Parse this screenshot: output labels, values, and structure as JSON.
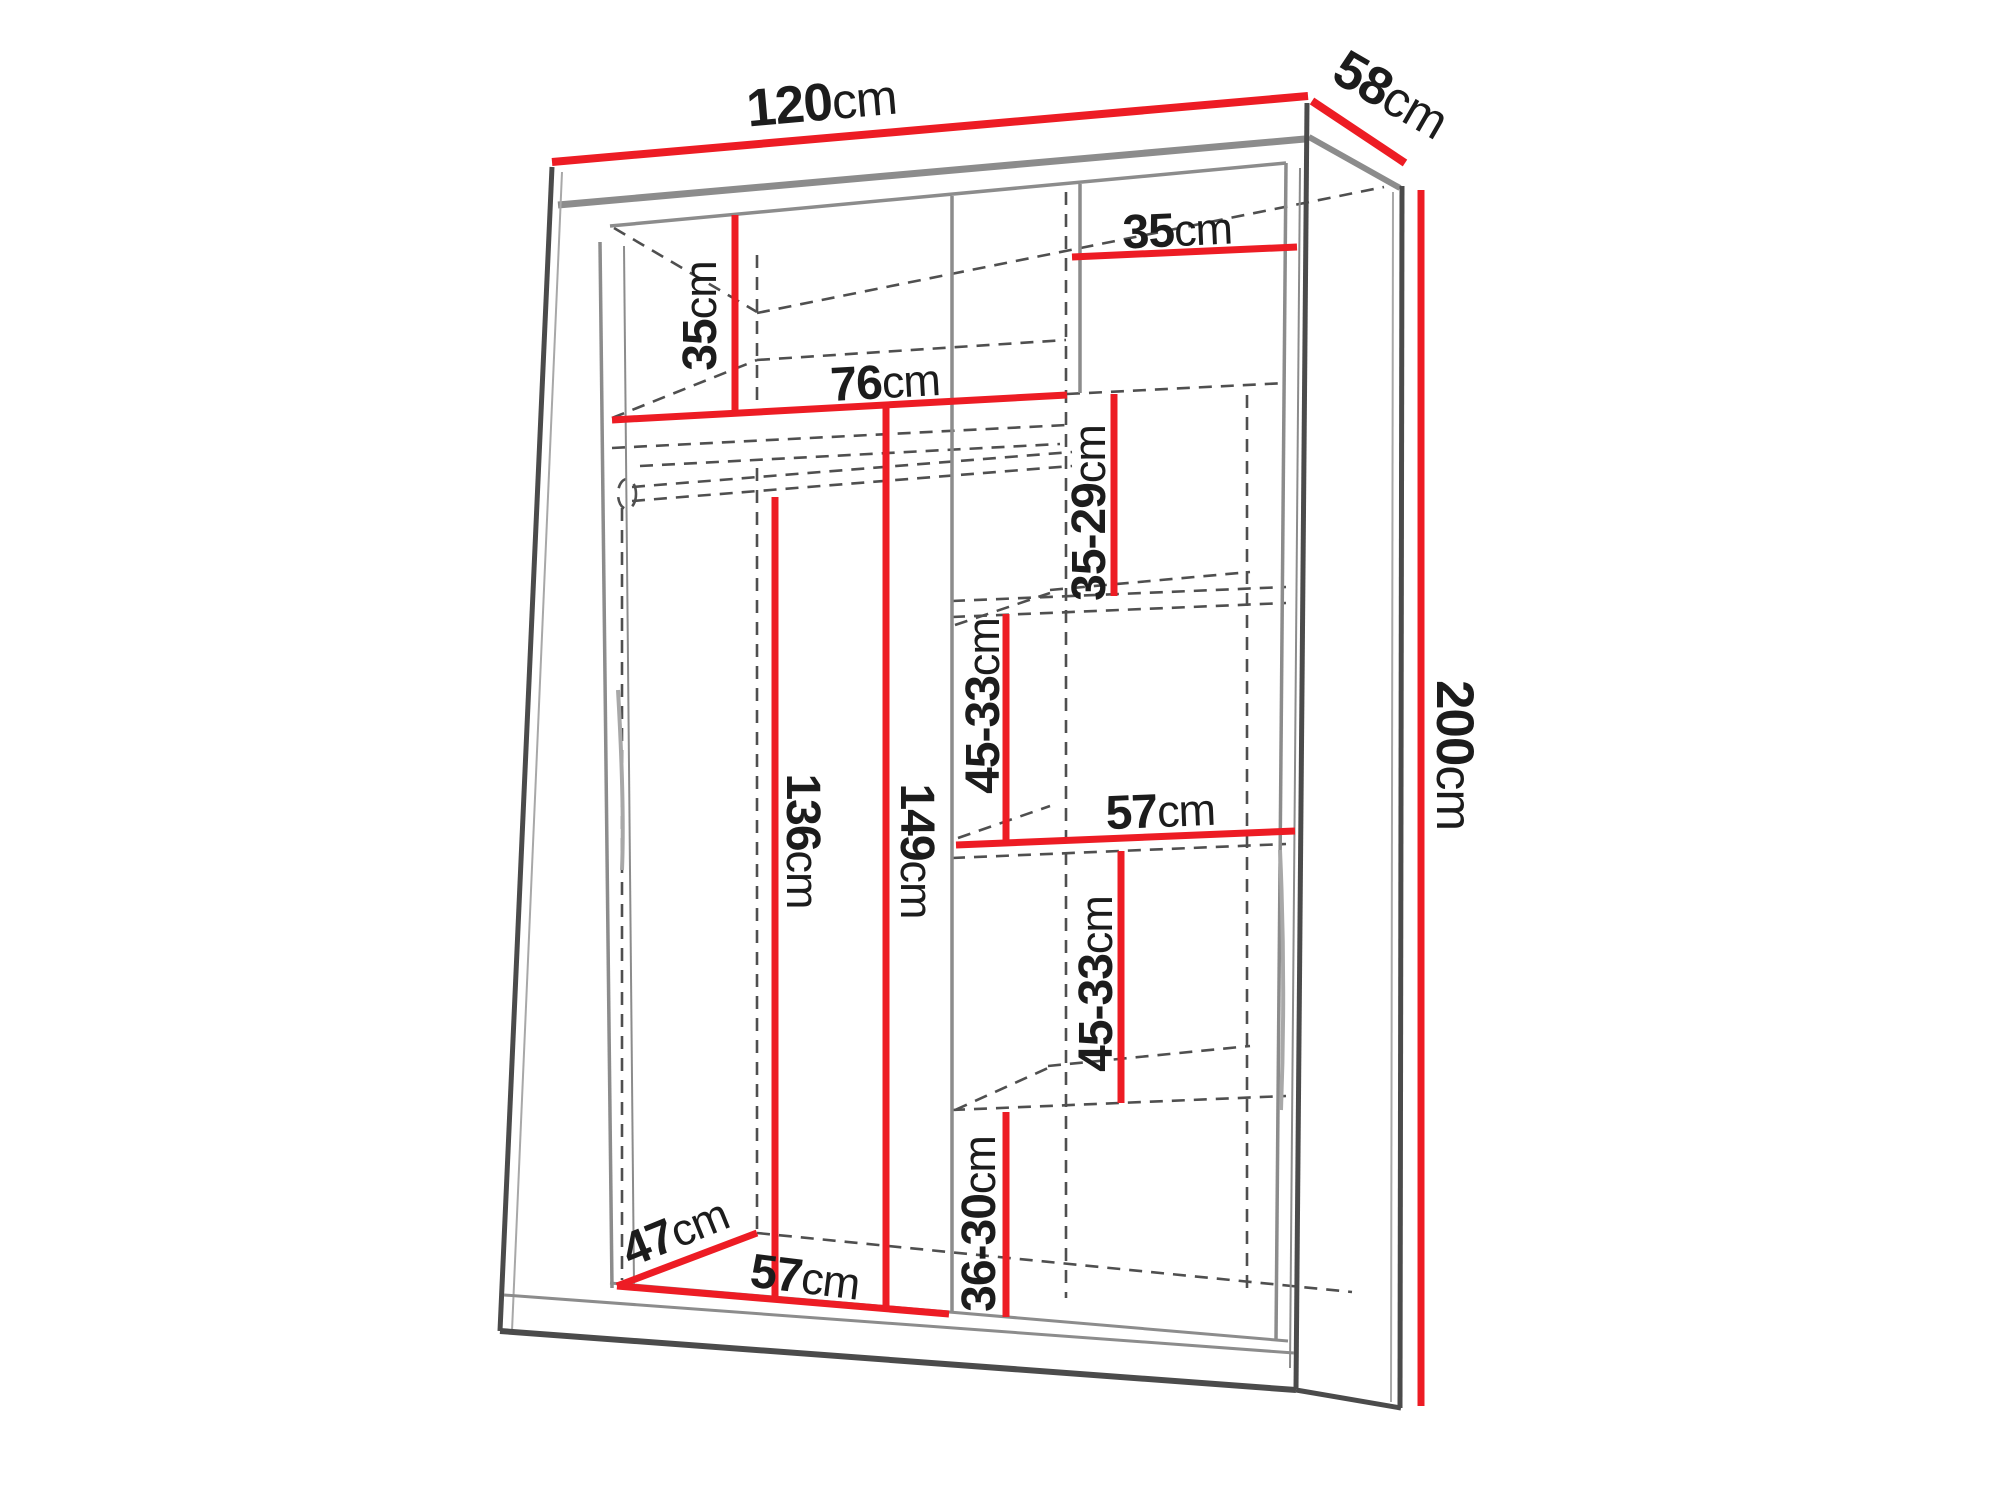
{
  "diagram": {
    "unit": "cm",
    "colors": {
      "dimension_red": "#ed1c24",
      "outline_dark": "#4b4b4b",
      "interior_gray": "#8c8c8c",
      "dashed_gray": "#4f4f4f",
      "text_black": "#1c1c1c",
      "background": "#ffffff"
    },
    "dims": {
      "width": {
        "value": "120",
        "unit": "cm"
      },
      "depth": {
        "value": "58",
        "unit": "cm"
      },
      "height": {
        "value": "200",
        "unit": "cm"
      },
      "top_left_height": {
        "value": "35",
        "unit": "cm"
      },
      "top_right_width": {
        "value": "35",
        "unit": "cm"
      },
      "left_width": {
        "value": "76",
        "unit": "cm"
      },
      "right_gap_top": {
        "value": "35-29",
        "unit": "cm"
      },
      "right_gap_upper": {
        "value": "45-33",
        "unit": "cm"
      },
      "right_shelf_width": {
        "value": "57",
        "unit": "cm"
      },
      "left_height_inner": {
        "value": "136",
        "unit": "cm"
      },
      "left_height_full": {
        "value": "149",
        "unit": "cm"
      },
      "right_gap_lower": {
        "value": "45-33",
        "unit": "cm"
      },
      "right_gap_bottom": {
        "value": "36-30",
        "unit": "cm"
      },
      "floor_depth": {
        "value": "47",
        "unit": "cm"
      },
      "floor_width": {
        "value": "57",
        "unit": "cm"
      }
    }
  }
}
